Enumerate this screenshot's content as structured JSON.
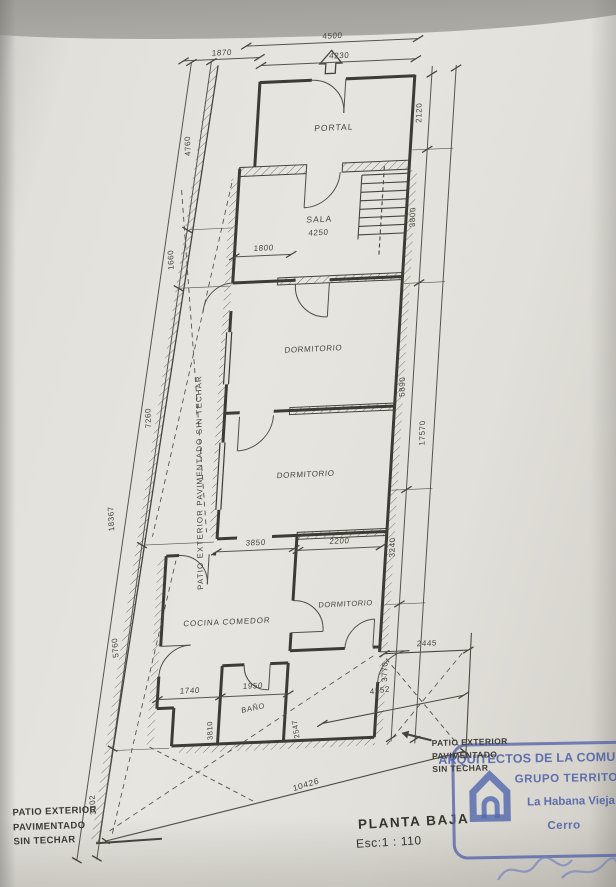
{
  "document": {
    "title": "PLANTA BAJA",
    "scale": "Esc:1 : 110"
  },
  "rooms": {
    "portal": "PORTAL",
    "sala": "SALA",
    "dormitorio_1": "DORMITORIO",
    "dormitorio_2": "DORMITORIO",
    "dormitorio_3": "DORMITORIO",
    "cocina_comedor": "COCINA COMEDOR",
    "bano": "BAÑO"
  },
  "patio": {
    "side_label": "PATIO EXTERIOR PAVIMENTADO SIN TECHAR",
    "bottom_left": [
      "PATIO EXTERIOR",
      "PAVIMENTADO",
      "SIN TECHAR"
    ],
    "near_stamp": [
      "PATIO EXTERIOR",
      "PAVIMENTADO",
      "SIN TECHAR"
    ]
  },
  "dims": {
    "d4500": "4500",
    "d4230": "4230",
    "d1870": "1870",
    "d1800": "1800",
    "d4250": "4250",
    "d4760": "4760",
    "d1660": "1660",
    "d7260": "7260",
    "d5760": "5760",
    "d3102": "3102",
    "d18367": "18367",
    "d2120": "2120",
    "d3800": "3800",
    "d5890": "5890",
    "d3240": "3240",
    "d3770": "3770",
    "d17570": "17570",
    "d3850": "3850",
    "d2200": "2200",
    "d1740": "1740",
    "d1950": "1950",
    "d3810": "3810",
    "d2547": "2547",
    "d2445": "2445",
    "d4252": "4252",
    "d10426": "10426"
  },
  "stamp": {
    "organization": "ARQUITECTOS DE LA COMUNIDAD",
    "group": "GRUPO TERRITORIAL",
    "municipality": "La Habana Vieja",
    "district": "Cerro"
  },
  "colors": {
    "paper": "#e5e3dd",
    "ink": "#45443d",
    "stamp_blue": "#4d5fa8"
  }
}
